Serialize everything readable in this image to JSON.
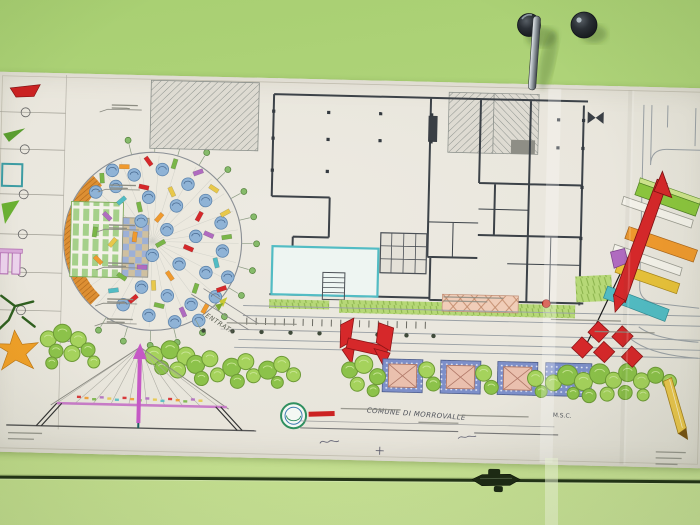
{
  "scene": {
    "labels": {
      "entrance": "ENTRATA",
      "plan_title": "COMUNE DI MORROVALLE",
      "annotation_msc": "M.S.C."
    },
    "palette": {
      "wall_top": "#a8cf72",
      "wall_bottom": "#cbe49a",
      "paper": "#e9e6de",
      "ink": "#3c4248",
      "road": "#9aa0a5",
      "tree_green": "#a5d25c",
      "tree_green_alt": "#8cc24a",
      "tree_edge": "#6d9a36",
      "stripe_green": "#a5d08a",
      "checker_blue": "#9db0d6",
      "checker_tan": "#cfc0a0",
      "crescent": "#dd8f33",
      "red": "#d6282a",
      "orange": "#f09a2e",
      "yellow": "#e8c23a",
      "green": "#8cc63e",
      "purple": "#b06bc0",
      "teal": "#52bcc4",
      "magenta_arrow": "#c558c5",
      "deck_pink": "#c87cc8",
      "stall_blue": "#7d8fc9",
      "stall_salmon": "#eac0ae",
      "stamp_green": "#2f8f5f",
      "rail": "#233417"
    },
    "decor": {
      "legend_rows": [
        40,
        77,
        122,
        162,
        200,
        238
      ],
      "chip_colors": [
        "#d6282a",
        "#f09a2e",
        "#7ab648",
        "#b06bc0",
        "#e8c84a",
        "#52bcc4"
      ],
      "confetti_discs": [
        [
          140,
          100
        ],
        [
          168,
          94
        ],
        [
          194,
          108
        ],
        [
          122,
          112
        ],
        [
          155,
          122
        ],
        [
          183,
          130
        ],
        [
          212,
          124
        ],
        [
          228,
          146
        ],
        [
          148,
          146
        ],
        [
          174,
          154
        ],
        [
          203,
          160
        ],
        [
          230,
          174
        ],
        [
          160,
          180
        ],
        [
          187,
          188
        ],
        [
          214,
          196
        ],
        [
          236,
          200
        ],
        [
          150,
          212
        ],
        [
          176,
          220
        ],
        [
          200,
          228
        ],
        [
          224,
          220
        ],
        [
          132,
          230
        ],
        [
          158,
          240
        ],
        [
          184,
          246
        ],
        [
          208,
          244
        ],
        [
          118,
          96
        ],
        [
          102,
          118
        ]
      ],
      "confetti_chips": [
        [
          130,
          92,
          1
        ],
        [
          154,
          86,
          0
        ],
        [
          180,
          88,
          2
        ],
        [
          204,
          96,
          3
        ],
        [
          220,
          112,
          4
        ],
        [
          108,
          104,
          2
        ],
        [
          128,
          126,
          5
        ],
        [
          150,
          112,
          0
        ],
        [
          178,
          116,
          4
        ],
        [
          206,
          140,
          0
        ],
        [
          234,
          160,
          2
        ],
        [
          114,
          142,
          3
        ],
        [
          142,
          162,
          1
        ],
        [
          168,
          168,
          2
        ],
        [
          196,
          172,
          0
        ],
        [
          224,
          186,
          5
        ],
        [
          120,
          168,
          4
        ],
        [
          150,
          192,
          3
        ],
        [
          178,
          200,
          1
        ],
        [
          204,
          212,
          2
        ],
        [
          230,
          212,
          0
        ],
        [
          130,
          202,
          2
        ],
        [
          162,
          210,
          4
        ],
        [
          142,
          224,
          0
        ],
        [
          168,
          230,
          2
        ],
        [
          192,
          236,
          3
        ],
        [
          214,
          232,
          1
        ],
        [
          122,
          216,
          5
        ],
        [
          106,
          186,
          1
        ],
        [
          102,
          158,
          2
        ],
        [
          232,
          136,
          4
        ],
        [
          216,
          158,
          3
        ],
        [
          146,
          132,
          2
        ],
        [
          166,
          142,
          1
        ]
      ],
      "trees": [
        [
          58,
          266,
          8
        ],
        [
          72,
          260,
          9
        ],
        [
          88,
          266,
          8
        ],
        [
          66,
          278,
          7
        ],
        [
          82,
          280,
          8
        ],
        [
          98,
          276,
          7
        ],
        [
          104,
          288,
          6
        ],
        [
          62,
          290,
          6
        ],
        [
          164,
          280,
          9
        ],
        [
          180,
          274,
          9
        ],
        [
          196,
          280,
          9
        ],
        [
          172,
          292,
          7
        ],
        [
          188,
          294,
          8
        ],
        [
          206,
          288,
          9
        ],
        [
          220,
          282,
          8
        ],
        [
          212,
          302,
          7
        ],
        [
          228,
          298,
          7
        ],
        [
          242,
          290,
          9
        ],
        [
          256,
          284,
          8
        ],
        [
          248,
          304,
          7
        ],
        [
          264,
          298,
          7
        ],
        [
          278,
          292,
          9
        ],
        [
          292,
          286,
          8
        ],
        [
          288,
          304,
          6
        ],
        [
          304,
          296,
          7
        ],
        [
          360,
          290,
          8
        ],
        [
          374,
          284,
          9
        ],
        [
          388,
          296,
          8
        ],
        [
          368,
          304,
          7
        ],
        [
          384,
          310,
          6
        ],
        [
          437,
          288,
          8
        ],
        [
          444,
          302,
          7
        ],
        [
          494,
          290,
          8
        ],
        [
          502,
          304,
          7
        ],
        [
          546,
          294,
          8
        ],
        [
          552,
          307,
          6
        ],
        [
          564,
          298,
          8
        ],
        [
          578,
          290,
          10
        ],
        [
          594,
          296,
          9
        ],
        [
          610,
          288,
          10
        ],
        [
          624,
          294,
          8
        ],
        [
          638,
          286,
          9
        ],
        [
          652,
          294,
          8
        ],
        [
          666,
          288,
          8
        ],
        [
          680,
          294,
          7
        ],
        [
          600,
          310,
          7
        ],
        [
          618,
          308,
          7
        ],
        [
          636,
          306,
          7
        ],
        [
          654,
          308,
          6
        ],
        [
          584,
          308,
          6
        ]
      ],
      "stalls": [
        [
          393,
          278
        ],
        [
          451,
          278
        ],
        [
          508,
          278
        ]
      ],
      "stall_plain": [
        556,
        278,
        46,
        33
      ],
      "diamonds": [
        [
          608,
          246
        ],
        [
          592,
          262
        ],
        [
          614,
          266
        ],
        [
          632,
          250
        ],
        [
          642,
          270
        ]
      ],
      "bollards_x": [
        213,
        242,
        271,
        300,
        329,
        358,
        387,
        416,
        443
      ],
      "fan_xs": [
        68,
        86,
        104,
        122,
        140,
        158,
        176,
        194,
        212,
        230
      ],
      "leader_rows": [
        38,
        118,
        158,
        196,
        232,
        252
      ]
    }
  }
}
